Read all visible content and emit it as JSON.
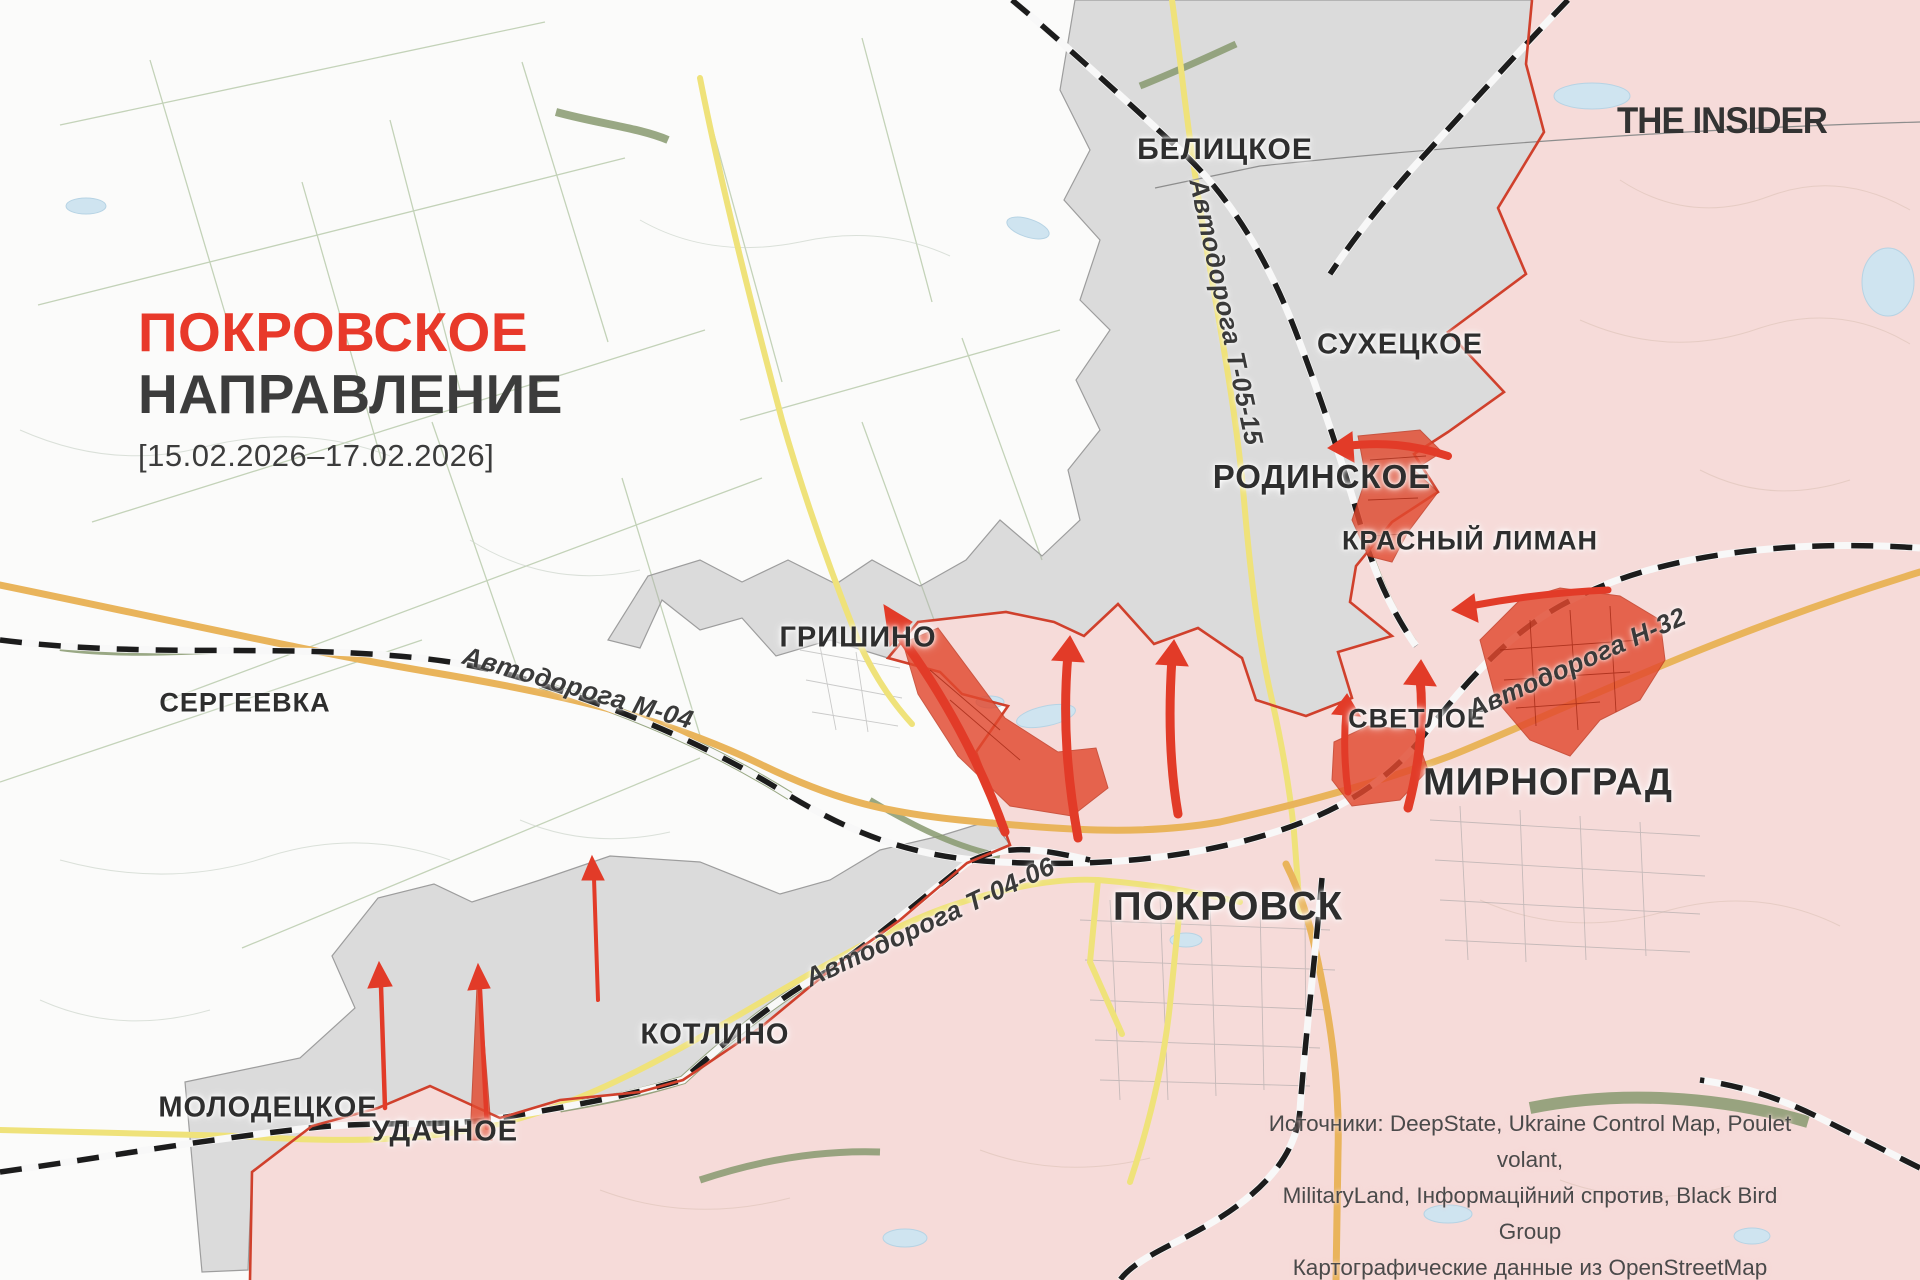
{
  "title": {
    "line1": "ПОКРОВСКОЕ",
    "line2": "НАПРАВЛЕНИЕ",
    "dates": "[15.02.2026–17.02.2026]"
  },
  "logo": "THE INSIDER",
  "towns": [
    {
      "label": "БЕЛИЦКОЕ"
    },
    {
      "label": "СУХЕЦКОЕ"
    },
    {
      "label": "РОДИНСКОЕ"
    },
    {
      "label": "КРАСНЫЙ ЛИМАН"
    },
    {
      "label": "ГРИШИНО"
    },
    {
      "label": "СЕРГЕЕВКА"
    },
    {
      "label": "СВЕТЛОЕ"
    },
    {
      "label": "МИРНОГРАД"
    },
    {
      "label": "ПОКРОВСК"
    },
    {
      "label": "КОТЛИНО"
    },
    {
      "label": "МОЛОДЕЦКОЕ"
    },
    {
      "label": "УДАЧНОЕ"
    }
  ],
  "road_labels": [
    {
      "label": "Автодорога Т-05-15"
    },
    {
      "label": "Автодорога М-04"
    },
    {
      "label": "Автодорога Н-32"
    },
    {
      "label": "Автодорога Т-04-06"
    }
  ],
  "sources": {
    "line1": "Источники: DeepState, Ukraine Control Map, Poulet volant,",
    "line2": "MilitaryLand, Інформаційний спротив, Black Bird Group",
    "line3": "Картографические данные из OpenStreetMap"
  },
  "map_legend_colors": {
    "russian_control_fill": "#f6dbd9",
    "contested_gray_fill": "#d6d6d6",
    "recent_advance_red": "#e2492f",
    "front_line_red": "#d0402c",
    "attack_arrow_red": "#e23b28",
    "major_road_orange": "#e9b45b",
    "secondary_road_yellow": "#efe27a",
    "railway_black": "#1a1a1a",
    "title_red": "#e8392a"
  }
}
